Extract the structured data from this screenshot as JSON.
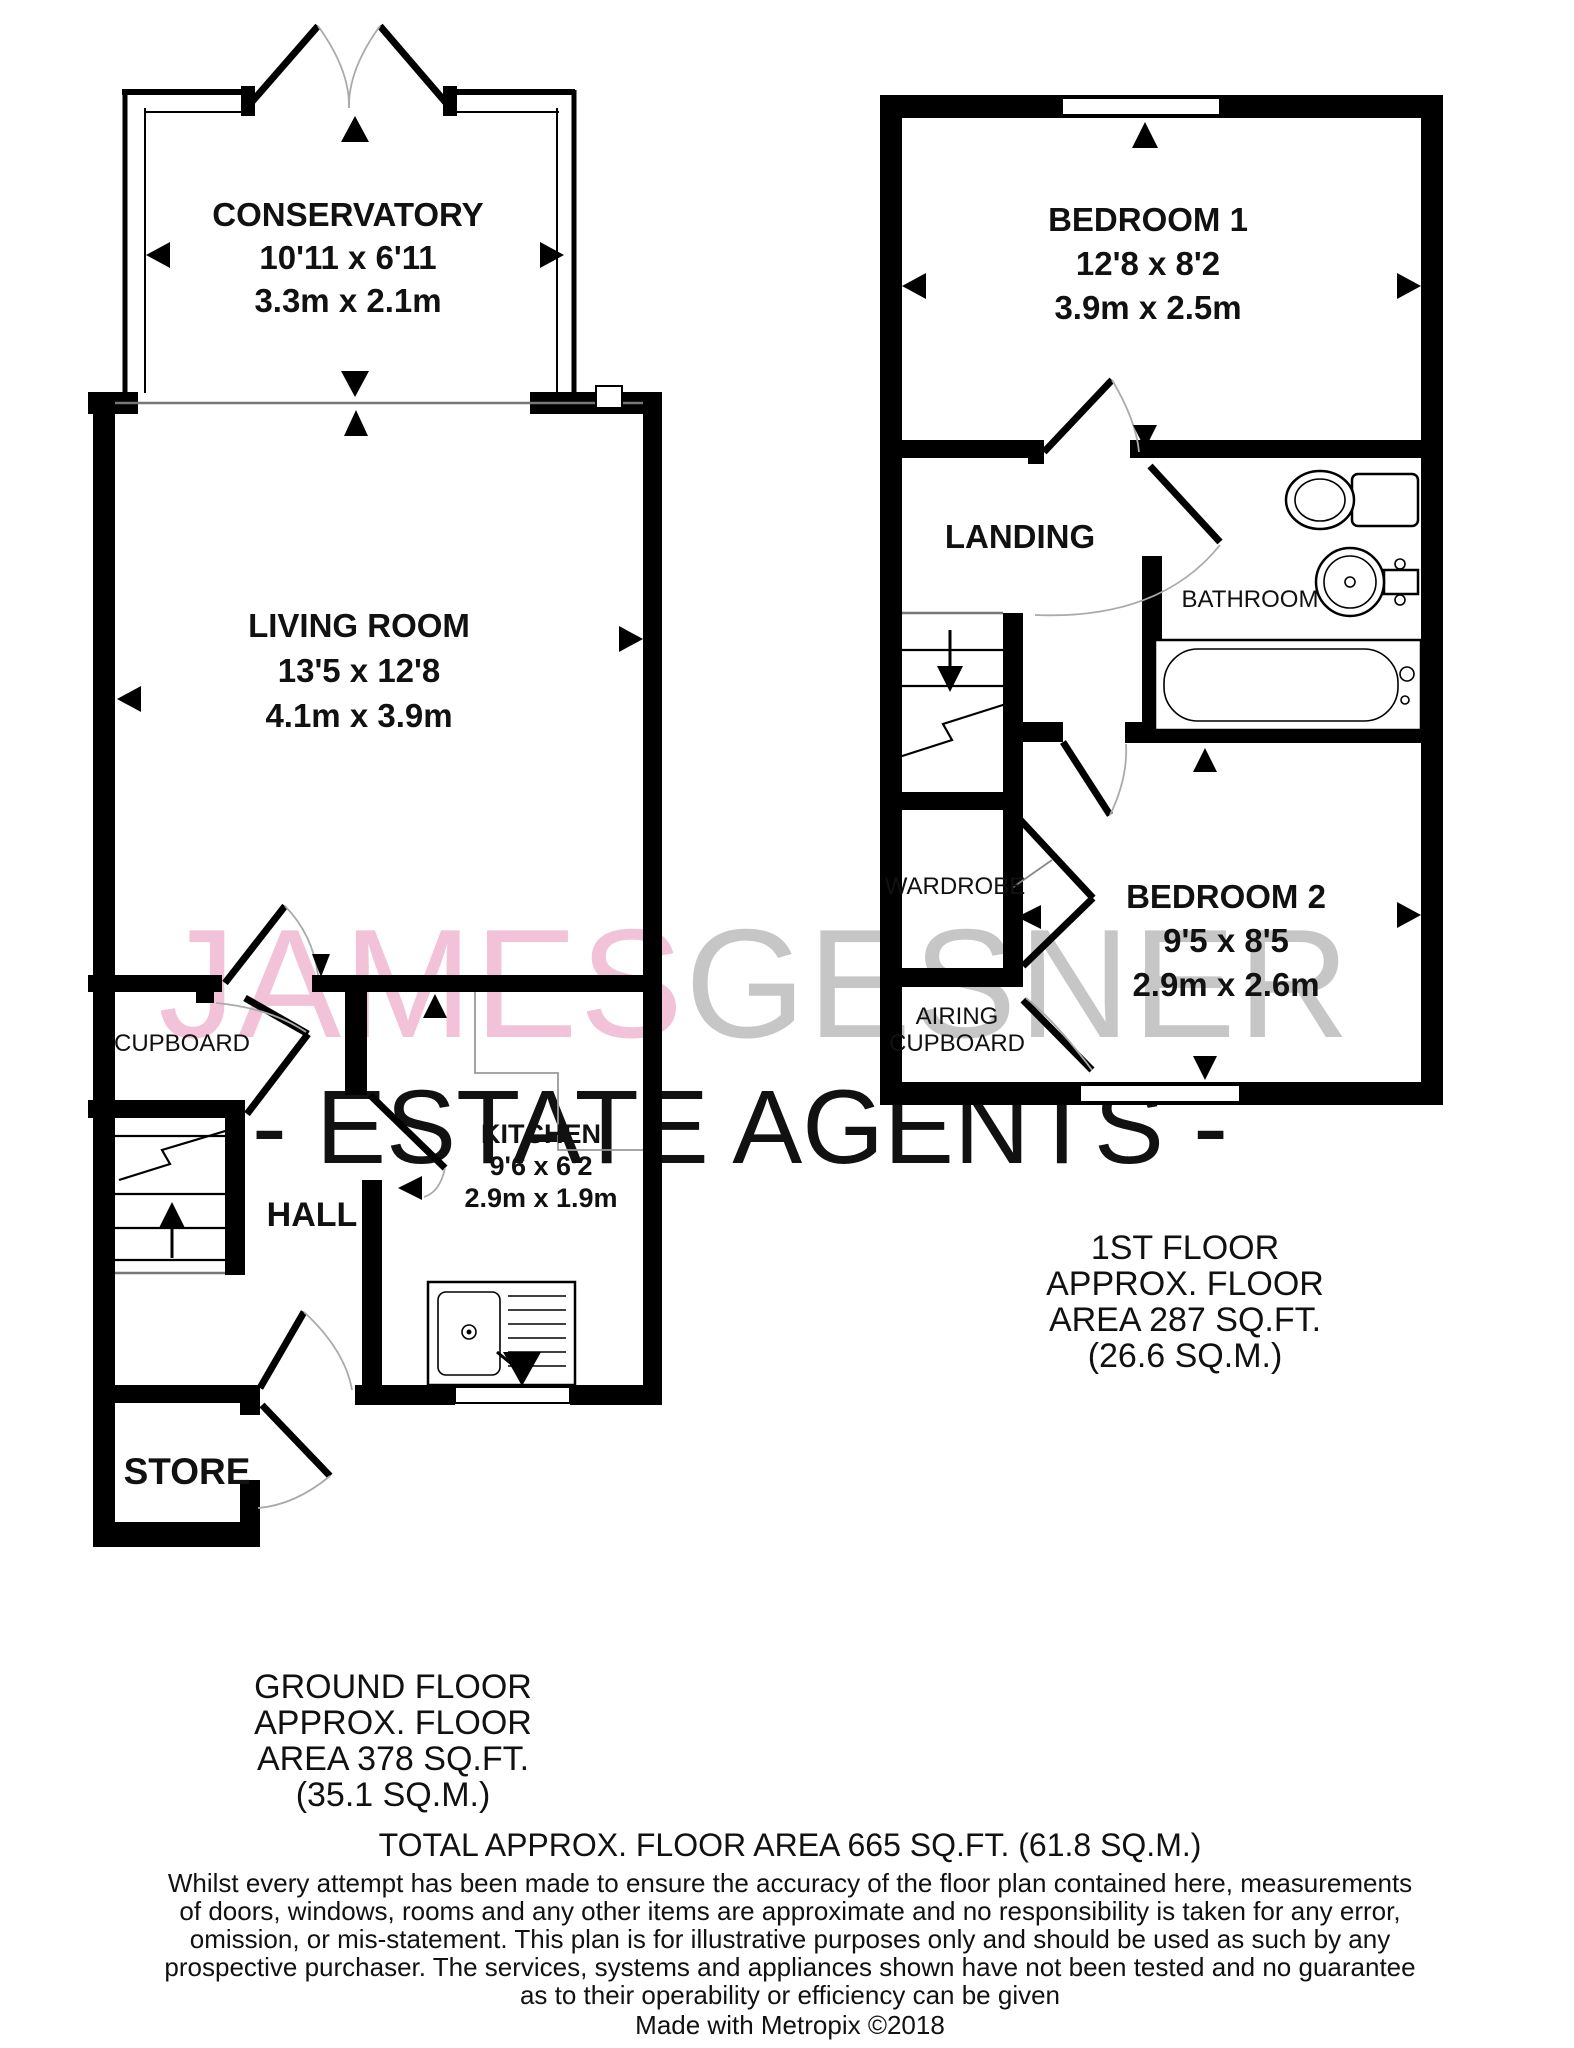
{
  "watermark": {
    "brand_primary": "JAMES",
    "brand_secondary": "GESNER",
    "tagline": "- ESTATE AGENTS -",
    "pink": "#f2c3d8",
    "gray": "#c6c6c6",
    "gray_light": "#d0d0d0"
  },
  "ground_floor": {
    "conservatory": {
      "name": "CONSERVATORY",
      "size_imperial": "10'11 x 6'11",
      "size_metric": "3.3m x 2.1m"
    },
    "living_room": {
      "name": "LIVING ROOM",
      "size_imperial": "13'5 x 12'8",
      "size_metric": "4.1m x 3.9m"
    },
    "kitchen": {
      "name": "KITCHEN",
      "size_imperial": "9'6 x 6'2",
      "size_metric": "2.9m x 1.9m"
    },
    "hall": {
      "name": "HALL"
    },
    "cupboard": {
      "name": "CUPBOARD"
    },
    "store": {
      "name": "STORE"
    },
    "area_line1": "GROUND FLOOR",
    "area_line2": "APPROX. FLOOR",
    "area_line3": "AREA 378 SQ.FT.",
    "area_line4": "(35.1 SQ.M.)"
  },
  "first_floor": {
    "bedroom1": {
      "name": "BEDROOM 1",
      "size_imperial": "12'8 x 8'2",
      "size_metric": "3.9m x 2.5m"
    },
    "bedroom2": {
      "name": "BEDROOM 2",
      "size_imperial": "9'5 x 8'5",
      "size_metric": "2.9m x 2.6m"
    },
    "landing": {
      "name": "LANDING"
    },
    "bathroom": {
      "name": "BATHROOM"
    },
    "wardrobe": {
      "name": "WARDROBE"
    },
    "airing_cupboard_line1": "AIRING",
    "airing_cupboard_line2": "CUPBOARD",
    "area_line1": "1ST FLOOR",
    "area_line2": "APPROX. FLOOR",
    "area_line3": "AREA 287 SQ.FT.",
    "area_line4": "(26.6 SQ.M.)"
  },
  "footer": {
    "total": "TOTAL APPROX. FLOOR AREA 665 SQ.FT. (61.8 SQ.M.)",
    "disclaimer_line1": "Whilst every attempt has been made to ensure the accuracy of the floor plan contained here, measurements",
    "disclaimer_line2": "of doors, windows, rooms and any other items are approximate and no responsibility is taken for any error,",
    "disclaimer_line3": "omission, or mis-statement. This plan is for illustrative purposes only and should be used as such by any",
    "disclaimer_line4": "prospective purchaser. The services, systems and appliances shown have not been tested and no guarantee",
    "disclaimer_line5": "as to their operability or efficiency can be given",
    "credit": "Made with Metropix ©2018"
  }
}
